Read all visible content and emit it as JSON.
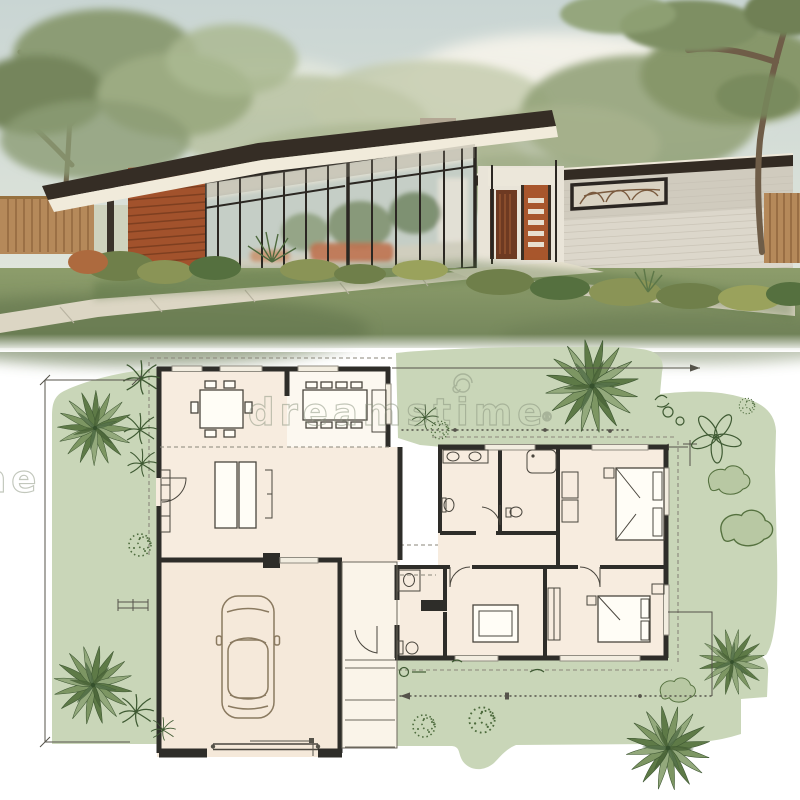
{
  "image": {
    "kind": "stock-architecture-illustration",
    "top_section": "exterior-rendering-midcentury-house",
    "bottom_section": "site-floor-plan"
  },
  "watermark": {
    "text": "dreamstime",
    "mark": "®",
    "logo": "spiral-d-icon"
  },
  "colors": {
    "wall": "#2e2d29",
    "dims": "#55534a",
    "watermark": "#87917c",
    "planLawn": "#c9d6b8",
    "roomCream": "#f7ecdf",
    "roomWhite": "#fcf8f0",
    "garageCream": "#f5e9da",
    "skyTop": "#c9d5d3",
    "skyBottom": "#e9ebe1",
    "roofDark": "#352d25",
    "fasciaCream": "#f1ebdb",
    "woodSiding": "#a2522c",
    "brickWall": "#dcd7cb",
    "doorOrange": "#a8562c",
    "lawnRender": "#84956a",
    "pathConcrete": "#dcd6c4",
    "fenceWood": "#b5895a",
    "treeDark": "#5e7a47",
    "treeMid": "#7d9663",
    "treeLight": "#93a97c"
  },
  "floor_plan": {
    "rooms": [
      "dining-room",
      "kitchen-dining-annex",
      "living-room",
      "laundry-bath",
      "bathroom",
      "bedroom-1",
      "bedroom-2",
      "bedroom-3",
      "hall-bath",
      "garage",
      "entry-porch"
    ],
    "furniture": [
      "dining-table-6-chairs",
      "dining-table-8-chairs",
      "media-cabinet",
      "sofa",
      "double-vanity",
      "toilet",
      "bathtub",
      "bed-with-pillows",
      "bed-rug",
      "bed-with-pillows",
      "car-top-view"
    ],
    "landscape": [
      "lawn",
      "fan-palm-tree",
      "small-palm-sketch",
      "stipple-shrub",
      "outline-shrub",
      "flower-sketch"
    ],
    "annotations": [
      "dimension-line-left",
      "dimension-arrow-top",
      "dotted-dimension-line",
      "dimension-line-bottom",
      "scale-bar",
      "garage-door-leader",
      "roof-overhang-dashes"
    ]
  },
  "rendering": {
    "elements": [
      "sky",
      "clouds",
      "background-trees",
      "left-tree",
      "right-tree",
      "flat-roof",
      "clerestory-glass-wall",
      "wood-slat-panel",
      "white-brick-wing",
      "chimney",
      "mural-clerestory-window",
      "slatted-front-door",
      "dark-entry-door",
      "wood-fence-left",
      "wood-fence-right",
      "shrub-border",
      "yucca-plant",
      "lawn",
      "concrete-walkway"
    ]
  }
}
